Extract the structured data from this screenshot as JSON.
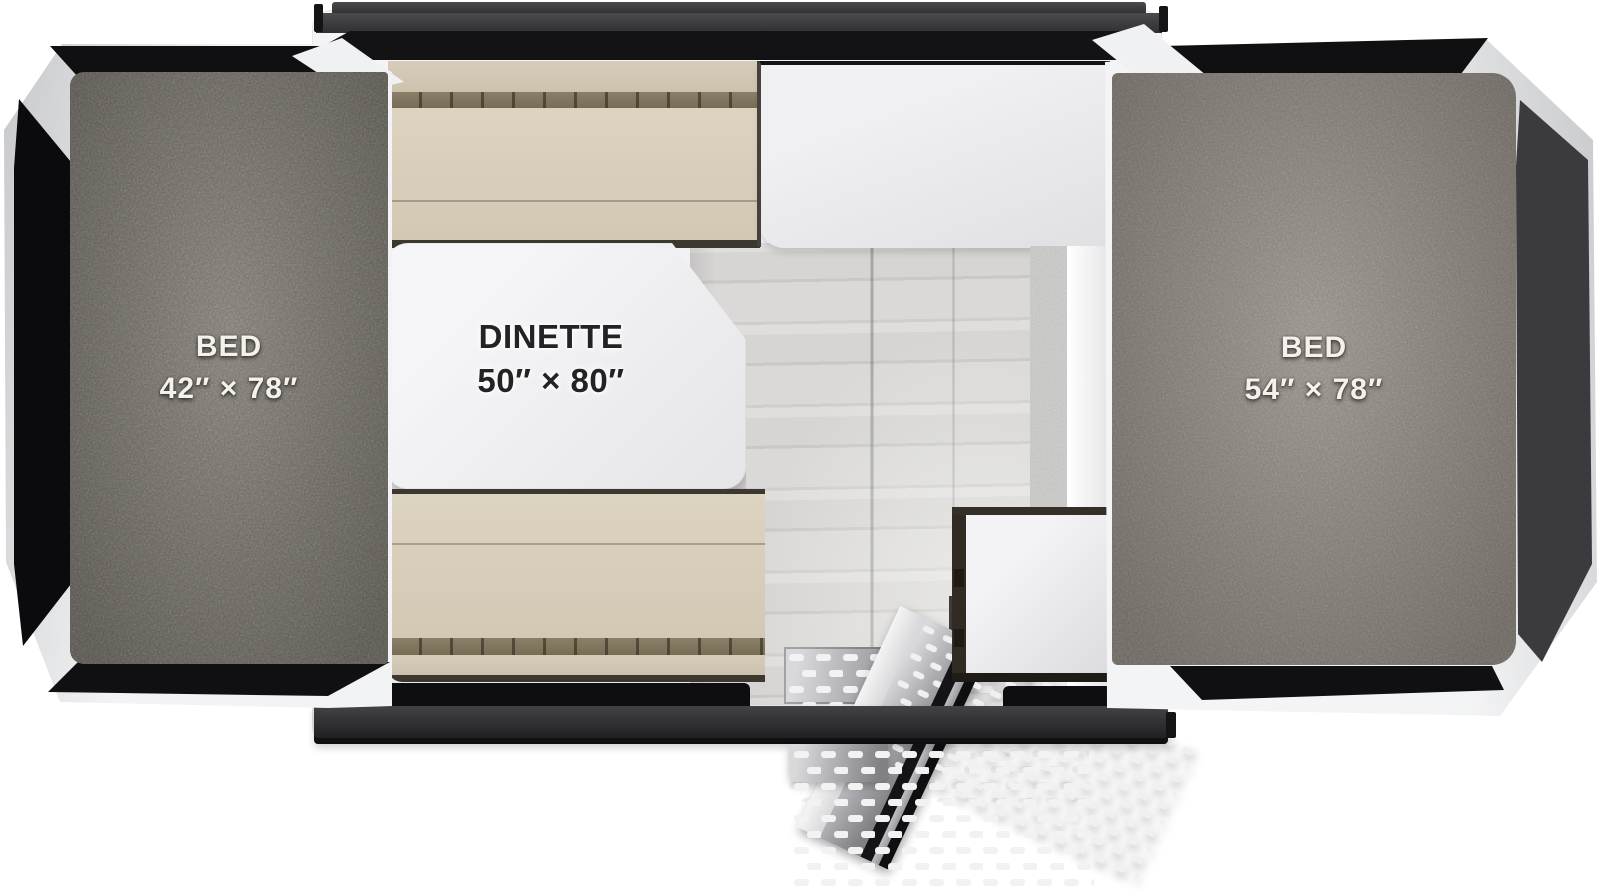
{
  "floorplan": {
    "title": "Pop-up camper floorplan (top view)",
    "left_bed": {
      "name": "BED",
      "size": "42″ × 78″"
    },
    "dinette": {
      "name": "DINETTE",
      "size": "50″ × 80″"
    },
    "right_bed": {
      "name": "BED",
      "size": "54″ × 78″"
    }
  },
  "colors": {
    "left_carpet": "#6e685f",
    "right_carpet": "#8a8279",
    "cushion_tan": "#d8cdbb",
    "tent_panel_black": "#101013",
    "tent_panel_grey": "#3b3b3f",
    "frame_white": "#f2f3f4",
    "rail_dark": "#1a1a1d",
    "table_white": "#f4f4f6",
    "floor_wood": "#d6d5d3",
    "label_light": "#f5f2ec",
    "label_dark": "#232326"
  }
}
